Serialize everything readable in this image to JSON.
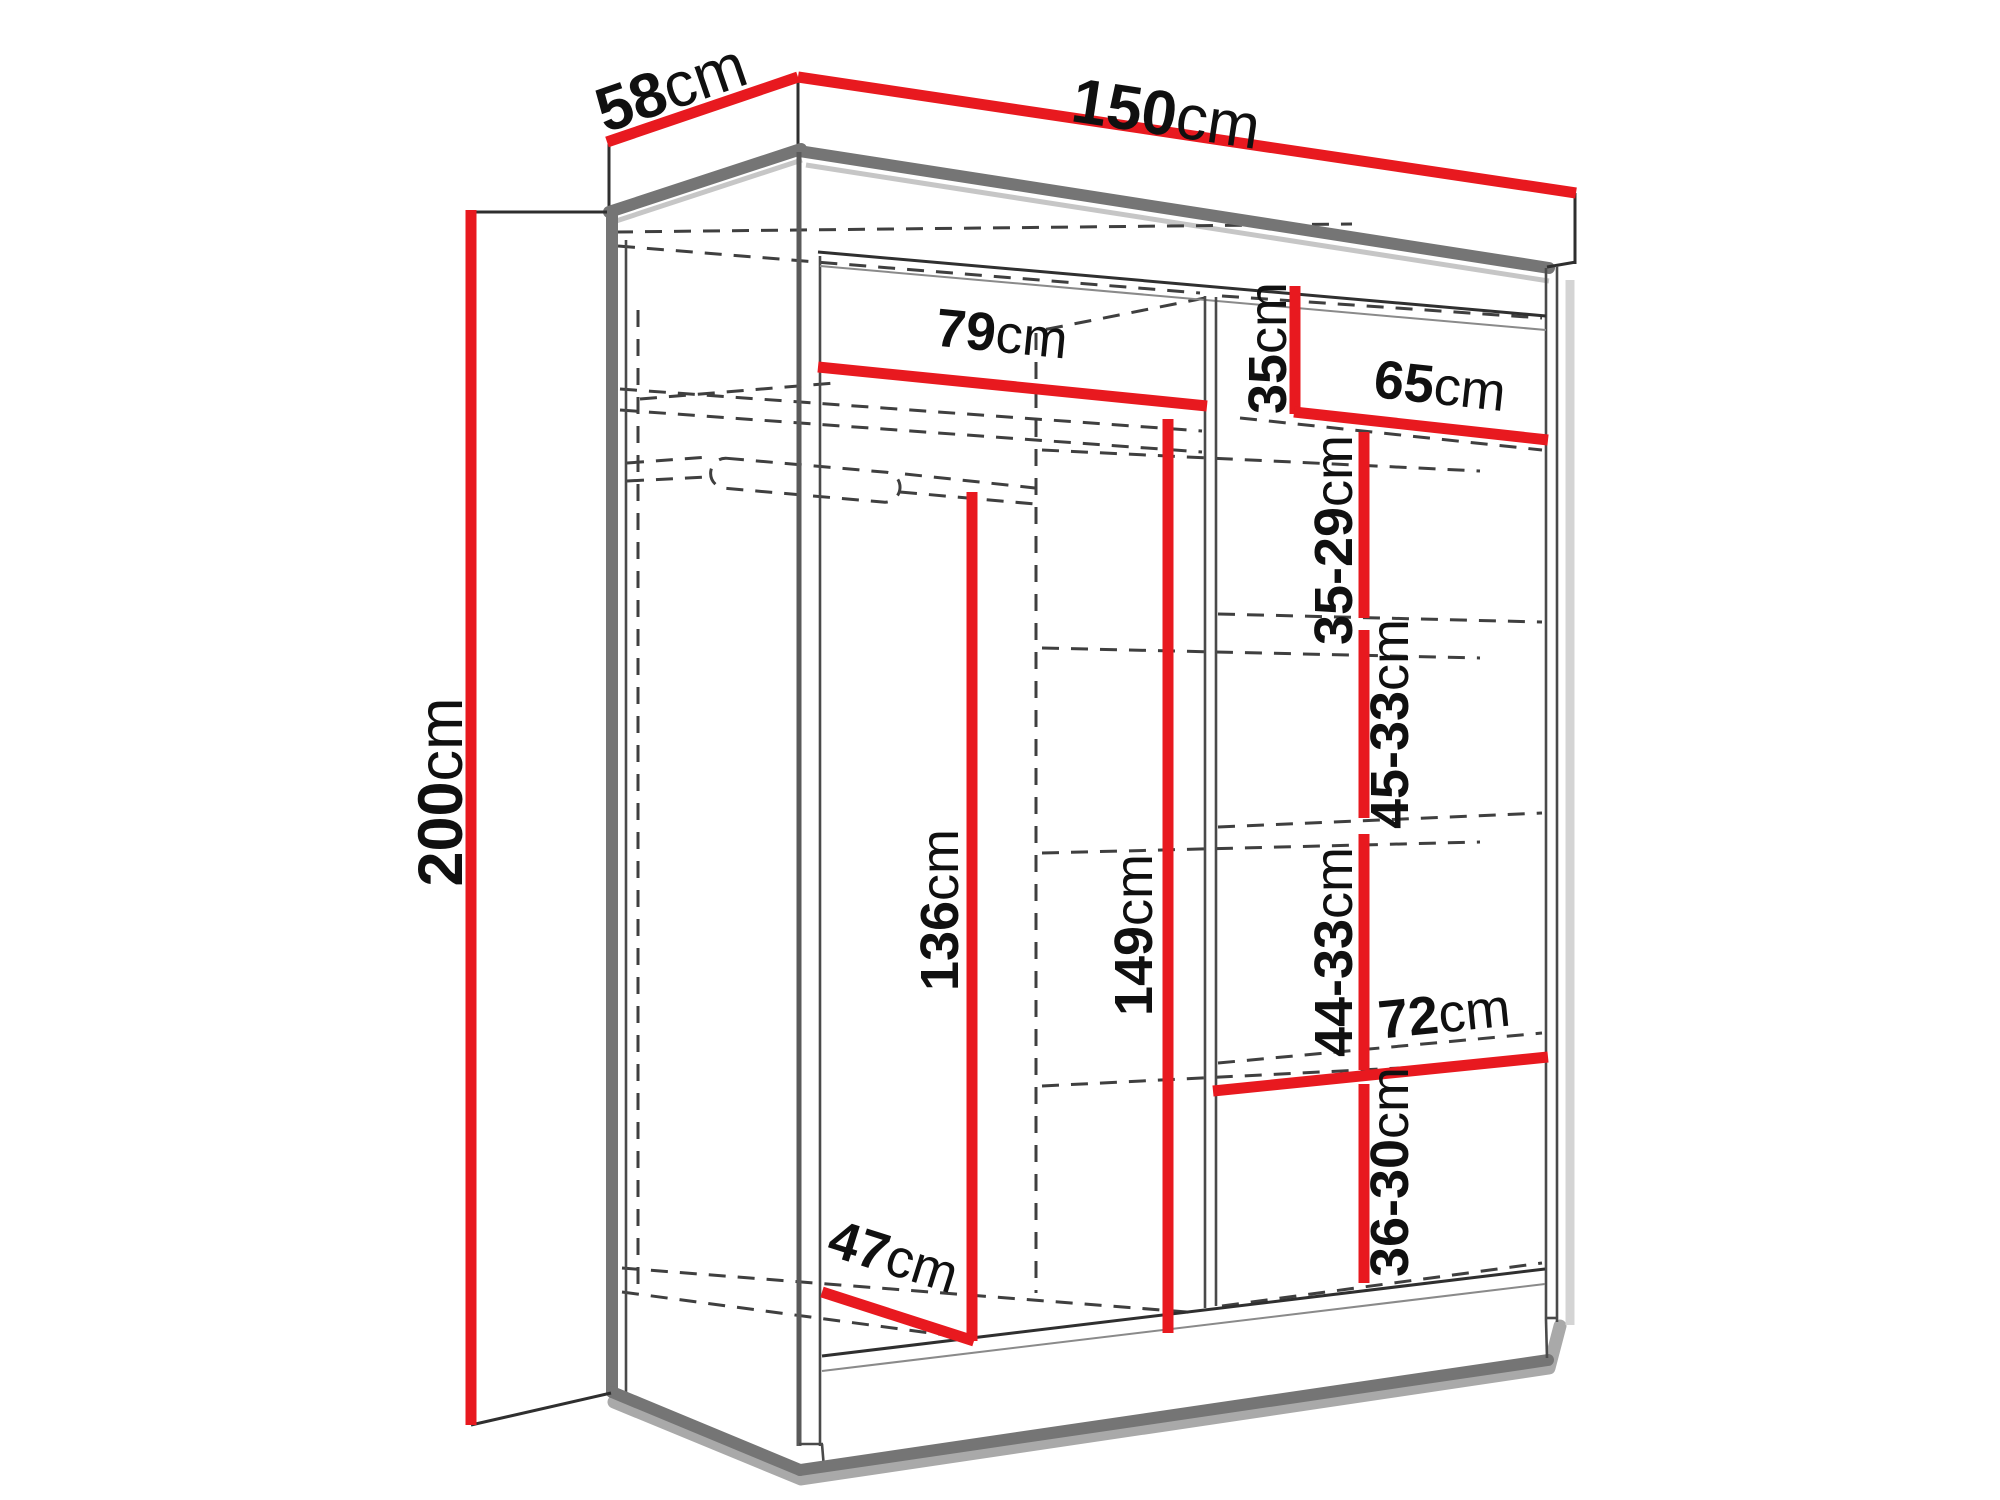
{
  "diagram": {
    "type": "wardrobe-dimension-diagram",
    "subject": "Perspective line drawing of a sliding-door wardrobe with red dimension lines, dashed hidden edges, shelves and a hanging rail",
    "background": "#ffffff",
    "colors": {
      "dimension_line": "#e8191f",
      "structure_edge": "#757575",
      "hidden_edge": "#3f3f3f",
      "label_text": "#101010",
      "background": "#ffffff"
    },
    "overall": {
      "width": {
        "value": "150",
        "unit": "cm"
      },
      "depth": {
        "value": "58",
        "unit": "cm"
      },
      "height": {
        "value": "200",
        "unit": "cm"
      }
    },
    "interior": {
      "left_section_width": {
        "value": "79",
        "unit": "cm"
      },
      "left_section_height": {
        "value": "149",
        "unit": "cm"
      },
      "hanging_space_height": {
        "value": "136",
        "unit": "cm"
      },
      "bottom_left_shelf_depth": {
        "value": "47",
        "unit": "cm"
      },
      "right_section_width": {
        "value": "65",
        "unit": "cm"
      },
      "top_right_compartment_height": {
        "value": "35",
        "unit": "cm"
      },
      "right_shelf_spacing_1": {
        "value": "35-29",
        "unit": "cm"
      },
      "right_shelf_spacing_2": {
        "value": "45-33",
        "unit": "cm"
      },
      "right_shelf_spacing_3": {
        "value": "44-33",
        "unit": "cm"
      },
      "right_shelf_spacing_4": {
        "value": "36-30",
        "unit": "cm"
      },
      "bottom_right_shelf_width": {
        "value": "72",
        "unit": "cm"
      }
    }
  }
}
